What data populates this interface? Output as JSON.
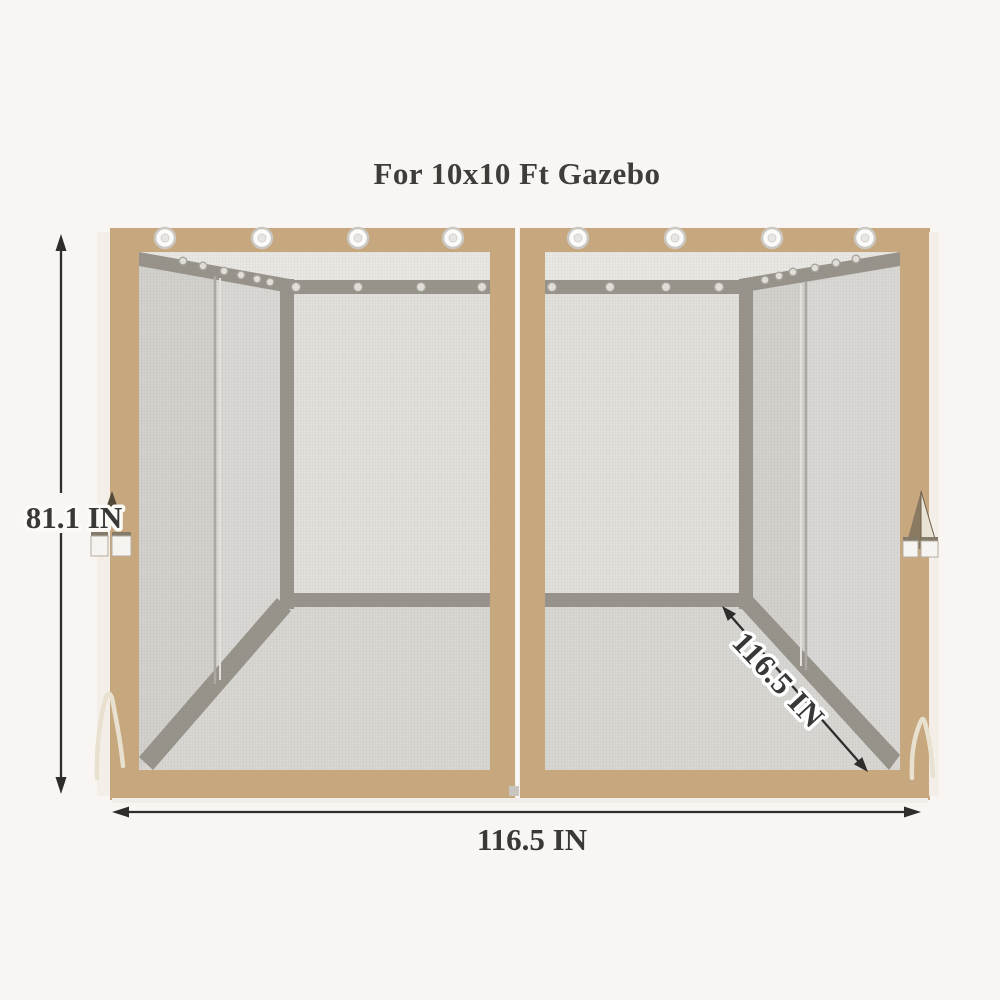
{
  "page": {
    "title": "For 10x10 Ft Gazebo",
    "background": "#f8f5f2"
  },
  "dimensions": {
    "height_label": "81.1 IN",
    "width_label": "116.5 IN",
    "depth_label": "116.5 IN"
  },
  "product": {
    "panels": 2,
    "grommets_top_per_panel": 4,
    "colors": {
      "frame_tan": "#c7a77d",
      "fabric_edge": "#f3efe8",
      "mesh_ceiling": "#eae8e4",
      "mesh_back_wall": "#e1e0dc",
      "mesh_side_wall": "#d2d1cd",
      "mesh_side_wall_light": "#d9d8d4",
      "mesh_floor": "#d8d7d3",
      "strap_gray": "#98938b",
      "grommet_white": "#fbfbfa",
      "dimension_line": "#2f2d2b",
      "label_text": "#3a3837",
      "tie_string": "#e9e1cf"
    }
  }
}
